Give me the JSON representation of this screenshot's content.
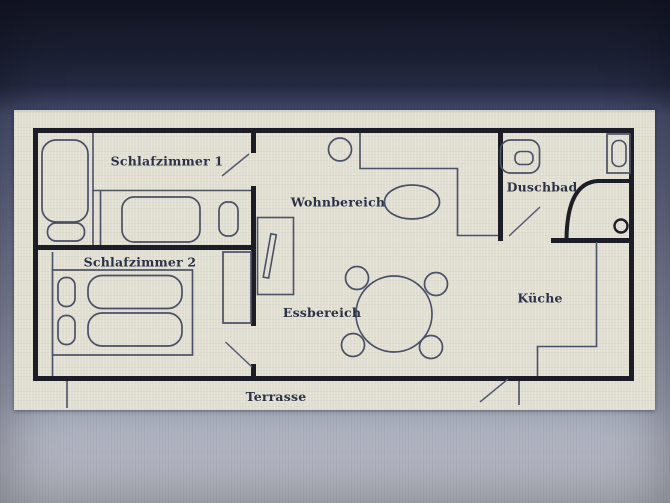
{
  "floor_plan": {
    "type": "apartment-floor-plan",
    "labels": {
      "schlafzimmer1": "Schlafzimmer 1",
      "schlafzimmer2": "Schlafzimmer 2",
      "wohnbereich": "Wohnbereich",
      "essbereich": "Essbereich",
      "duschbad": "Duschbad",
      "kueche": "Küche",
      "terrasse": "Terrasse"
    }
  },
  "colors": {
    "photo_background_top": "#141726",
    "photo_background_bottom": "#babdc6",
    "paper": "#e9e6d9",
    "wall": "#1c1d26",
    "furniture_line": "#4b5166",
    "label_text": "#2b3247"
  }
}
